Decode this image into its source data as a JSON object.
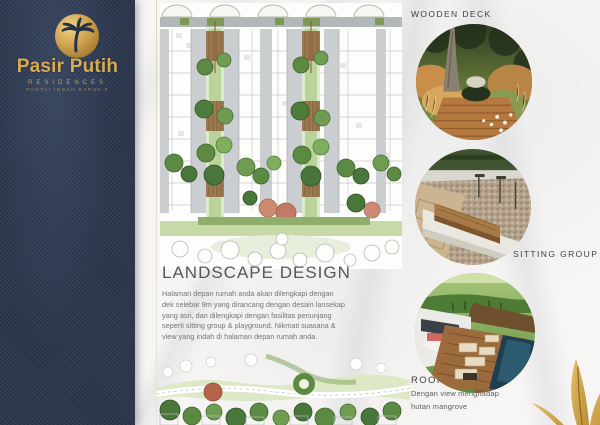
{
  "brand": {
    "name": "Pasir Putih",
    "subtitle": "RESIDENCES",
    "tagline": "PANTAI INDAH KAPUK 2",
    "logo_icon": "palm-tree-in-gold-circle",
    "colors": {
      "panel_navy": "#2c3850",
      "gold": "#c9a24b"
    }
  },
  "main": {
    "heading": "LANDSCAPE DESIGN",
    "paragraph": "Halaman depan rumah anda akan dilengkapi dengan dek selebar 9m yang dirancang dengan desain lansekap yang asri, dan dilengkapi dengan fasilitas penunjang seperti sitting group & playground. Nikmati suasana & view yang indah di halaman depan rumah anda.",
    "top_illustration": "residential site plan with green corridors, wooden decks and trees",
    "bottom_illustration": "front-yard landscape plan with playground swirl and tree rows"
  },
  "gallery": {
    "items": [
      {
        "label": "WOODEN DECK",
        "photo": "garden with tree, grasses and wooden deck"
      },
      {
        "label": "SITTING GROUP",
        "photo": "wooden bench on concrete ledge beside gravel"
      },
      {
        "label": "ROOFTOP",
        "photo": "aerial rooftop terrace with pool and lounge furniture",
        "caption": "Dengan view menghadap hutan mangrove"
      }
    ]
  },
  "decor": {
    "corner_graphic": "gold-palm-leaf",
    "background": "white-marble",
    "text_gray": "#565656"
  }
}
